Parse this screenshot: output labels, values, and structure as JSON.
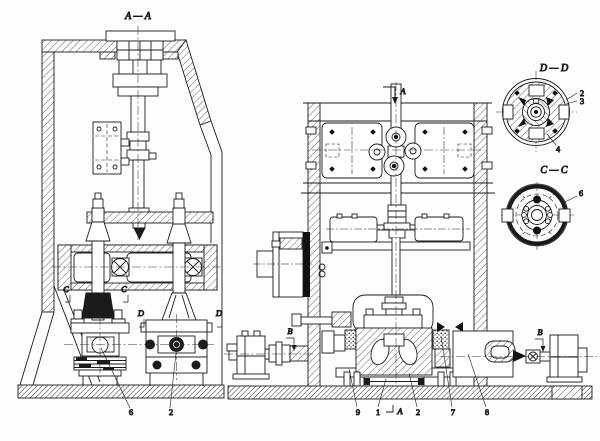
{
  "drawing": {
    "palette": {
      "background": "#fdfdfb",
      "ink": "#1b1b1b",
      "hatch": "#3a3a3a"
    },
    "views": {
      "section_aa": {
        "title": "A — A",
        "marks": {
          "c1": "C",
          "c2": "C",
          "d1": "D",
          "d2": "D"
        },
        "callouts": {
          "n6": "6",
          "n2": "2"
        }
      },
      "front": {
        "top_cut": "A",
        "base_cut": "A",
        "marks": {
          "b1": "B",
          "b2": "B"
        },
        "callouts": {
          "n9": "9",
          "n1": "1",
          "n2": "2",
          "n7": "7",
          "n8": "8"
        }
      },
      "detail_dd": {
        "title": "D — D",
        "callouts": {
          "n2": "2",
          "n3": "3",
          "n4": "4"
        }
      },
      "detail_cc": {
        "title": "C — C",
        "callouts": {
          "n6": "6"
        }
      }
    }
  }
}
